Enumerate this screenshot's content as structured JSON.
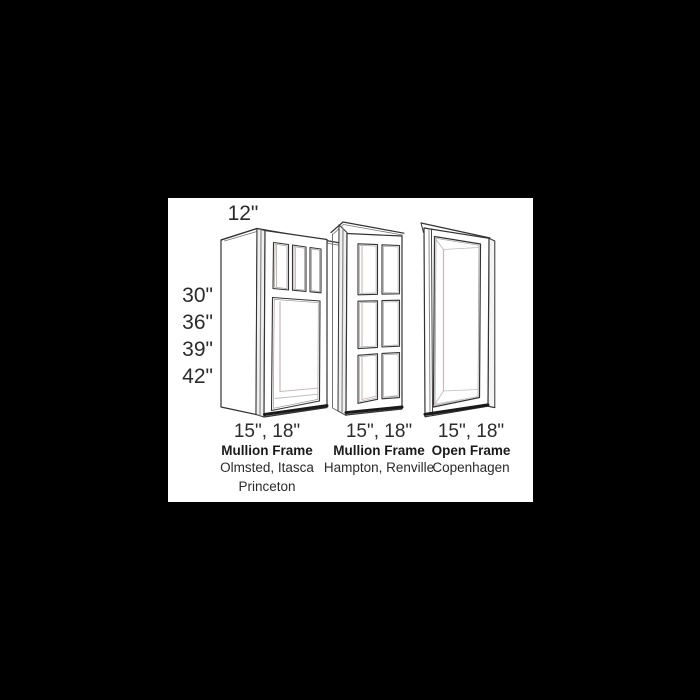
{
  "panel": {
    "page_background": "#000000",
    "background": "#ffffff"
  },
  "diagram": {
    "depth_label": "12\"",
    "height_labels": [
      "30\"",
      "36\"",
      "39\"",
      "42\""
    ],
    "colors": {
      "outline": "#333333",
      "outline_heavy": "#1a1a1a",
      "trim_fill": "#f0f0f0",
      "interior_accent": "#c9b6b6",
      "interior_light": "#bbbbbb"
    },
    "cabinets": [
      {
        "width_label": "15\", 18\"",
        "frame_type": "Mullion Frame",
        "style_line1": "Olmsted, Itasca",
        "style_line2": "Princeton"
      },
      {
        "width_label": "15\", 18\"",
        "frame_type": "Mullion Frame",
        "style_line1": "Hampton, Renville",
        "style_line2": ""
      },
      {
        "width_label": "15\", 18\"",
        "frame_type": "Open Frame",
        "style_line1": "Copenhagen",
        "style_line2": ""
      }
    ]
  }
}
